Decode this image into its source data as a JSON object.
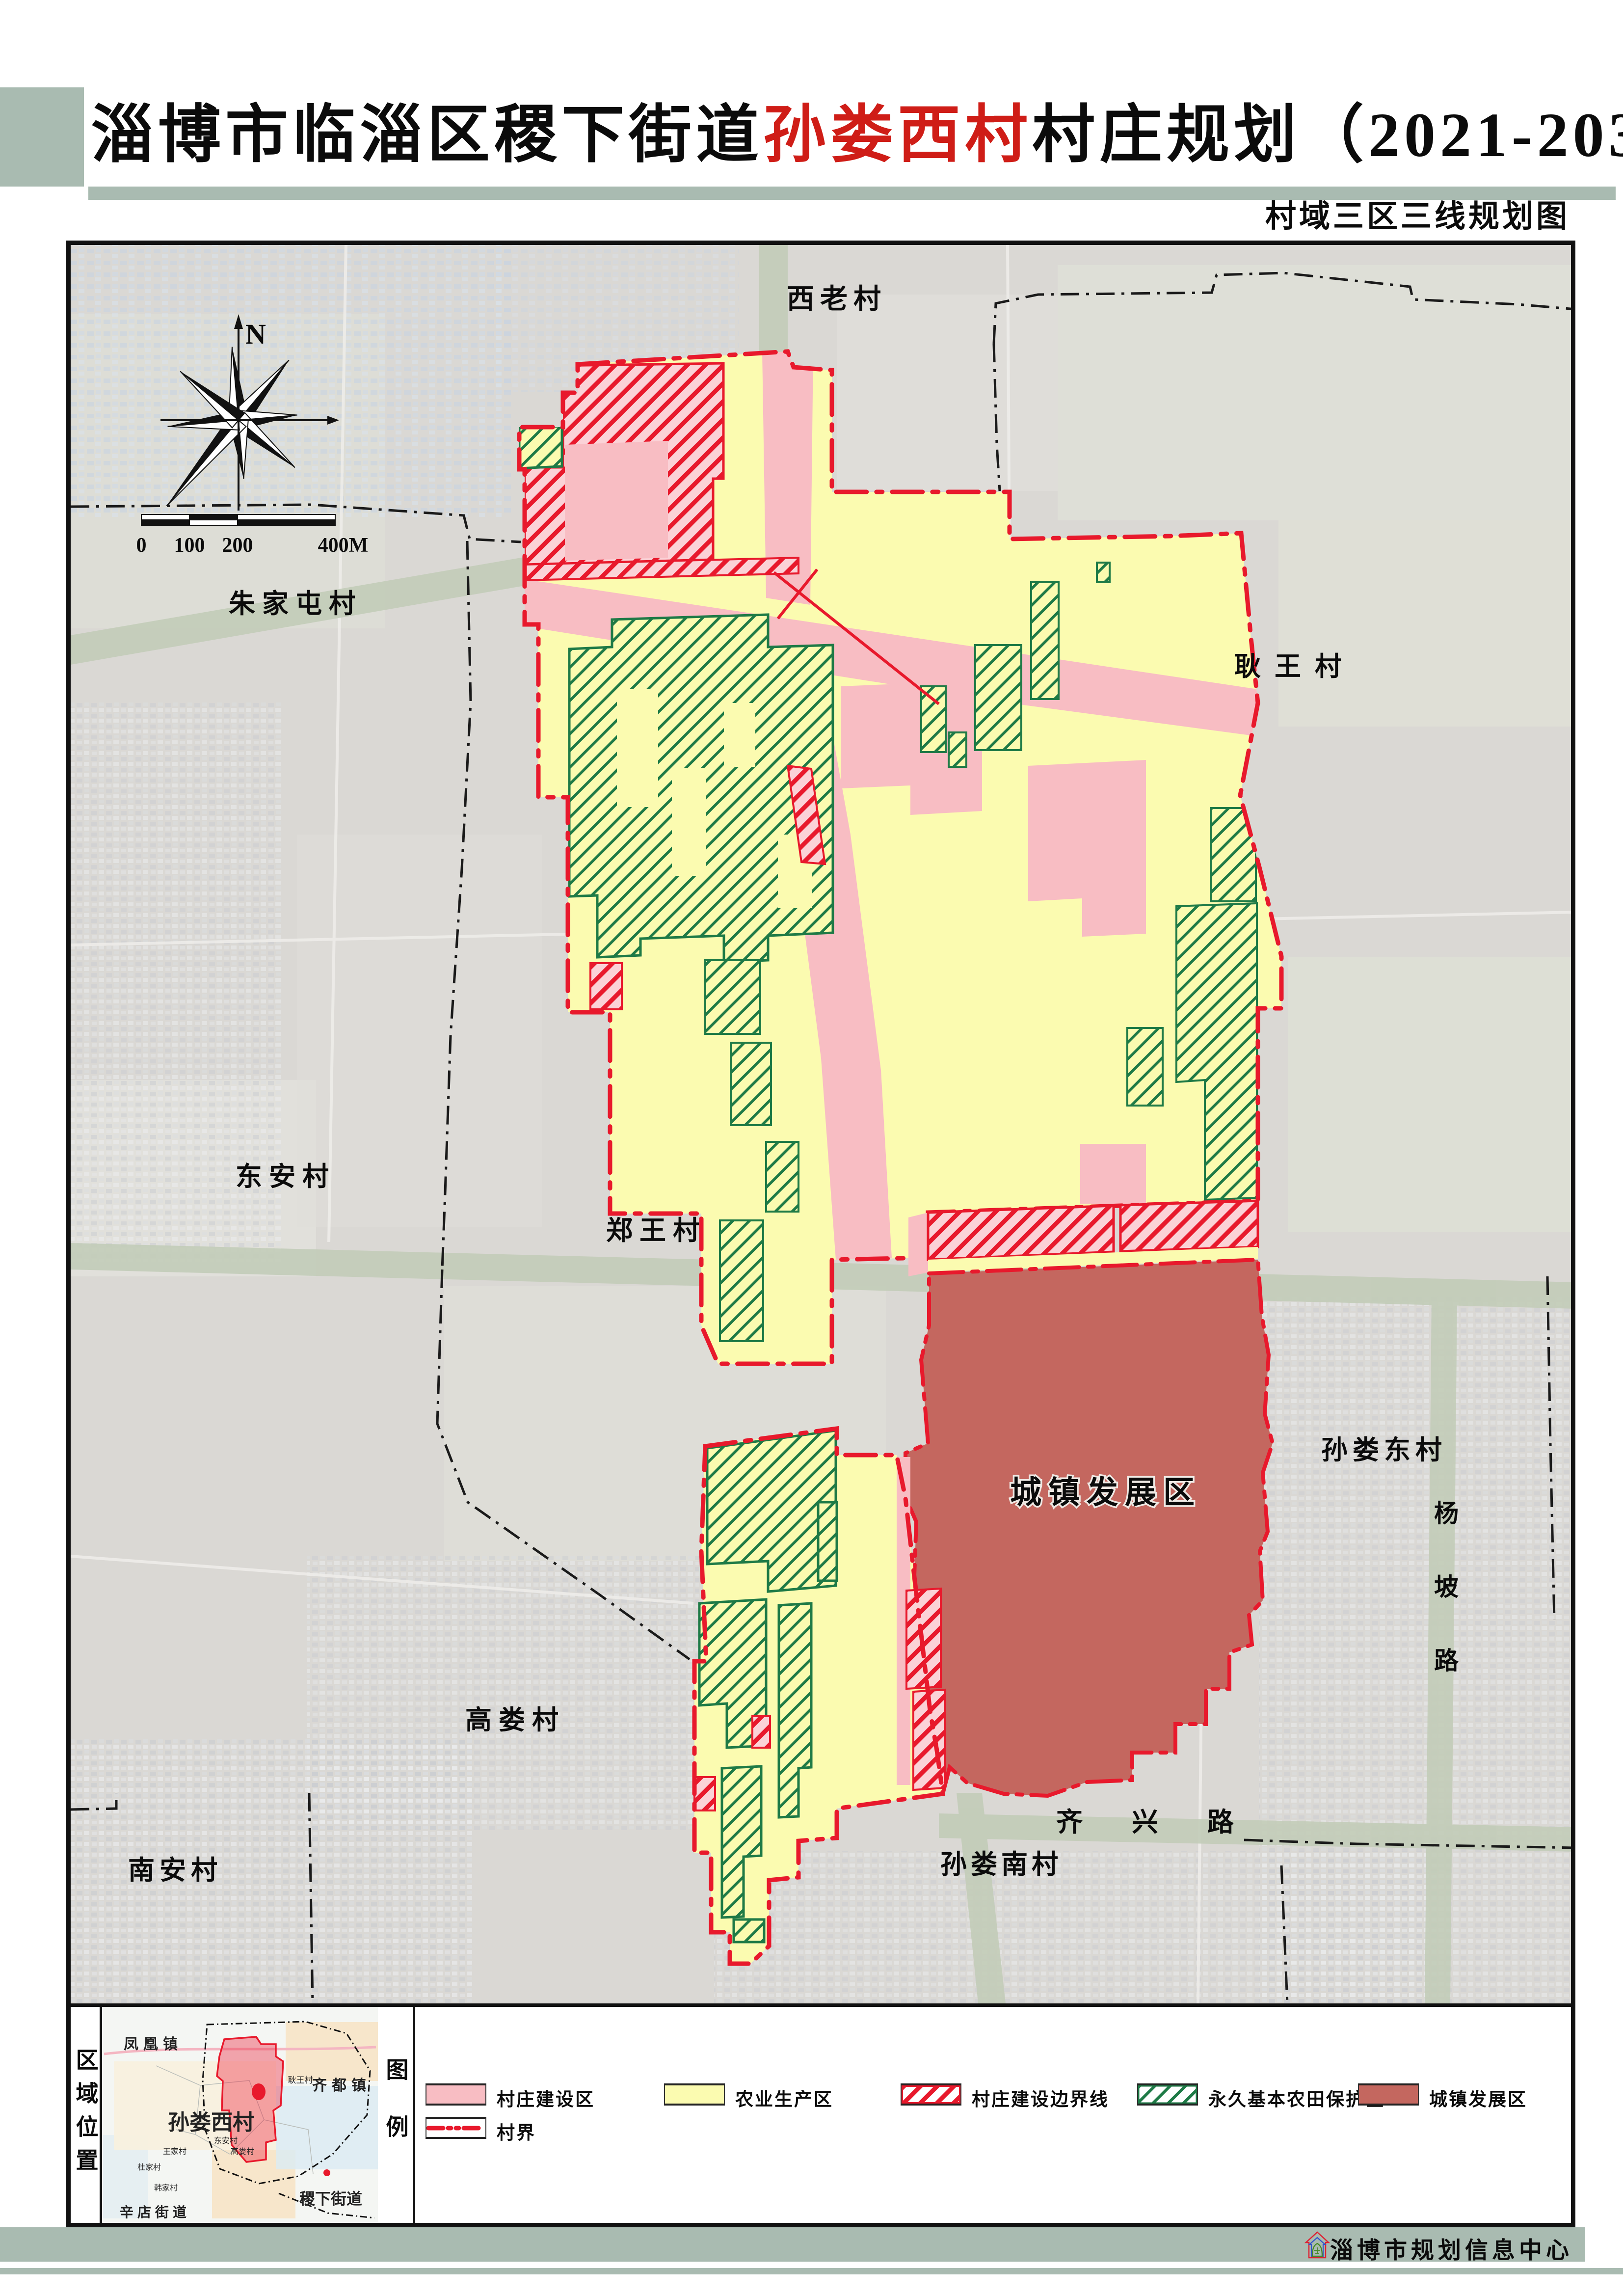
{
  "header": {
    "title_prefix": "淄博市临淄区稷下街道",
    "title_highlight": "孙娄西村",
    "title_suffix": "村庄规划（2021-2035年）",
    "subtitle": "村域三区三线规划图"
  },
  "compass": {
    "north": "N"
  },
  "scalebar": [
    "0",
    "100",
    "200",
    "400M"
  ],
  "map_labels": [
    {
      "text": "西老村"
    },
    {
      "text": "朱家屯村"
    },
    {
      "text": "耿王村"
    },
    {
      "text": "东安村"
    },
    {
      "text": "郑王村"
    },
    {
      "text": "城镇发展区"
    },
    {
      "text": "孙娄东村"
    },
    {
      "text": "杨"
    },
    {
      "text": "坡"
    },
    {
      "text": "路"
    },
    {
      "text": "高娄村"
    },
    {
      "text": "南安村"
    },
    {
      "text": "孙娄南村"
    },
    {
      "text": "齐兴路"
    }
  ],
  "panel": {
    "region_title": "区域位置",
    "legend_title": "图例"
  },
  "inset": {
    "fenghuang": "凤凰镇",
    "qidu": "齐都镇",
    "sunlouxi": "孙娄西村",
    "jixia": "稷下街道",
    "xindian": "辛店街道",
    "gengwang": "耿王村",
    "dongan": "东安村",
    "wangjia": "王家村",
    "dujia": "杜家村",
    "hanjia": "韩家村",
    "gaolou": "高娄村"
  },
  "legend": {
    "items": [
      {
        "label": "村庄建设区",
        "type": "pink-fill"
      },
      {
        "label": "农业生产区",
        "type": "yellow-fill"
      },
      {
        "label": "村庄建设边界线",
        "type": "red-hatch"
      },
      {
        "label": "永久基本农田保护区",
        "type": "green-hatch"
      },
      {
        "label": "城镇发展区",
        "type": "darkred-fill"
      }
    ],
    "boundary_label": "村界"
  },
  "footer": {
    "credit": "淄博市规划信息中心"
  },
  "colors": {
    "pink": "#F8BDC3",
    "yellow": "#FBFBB0",
    "red": "#E8192C",
    "green": "#1E7A46",
    "devred": "#C4675F",
    "sage": "#A9BBB1",
    "roadgreen": "#C2CCB8",
    "satbase": "#DAD8D4"
  }
}
